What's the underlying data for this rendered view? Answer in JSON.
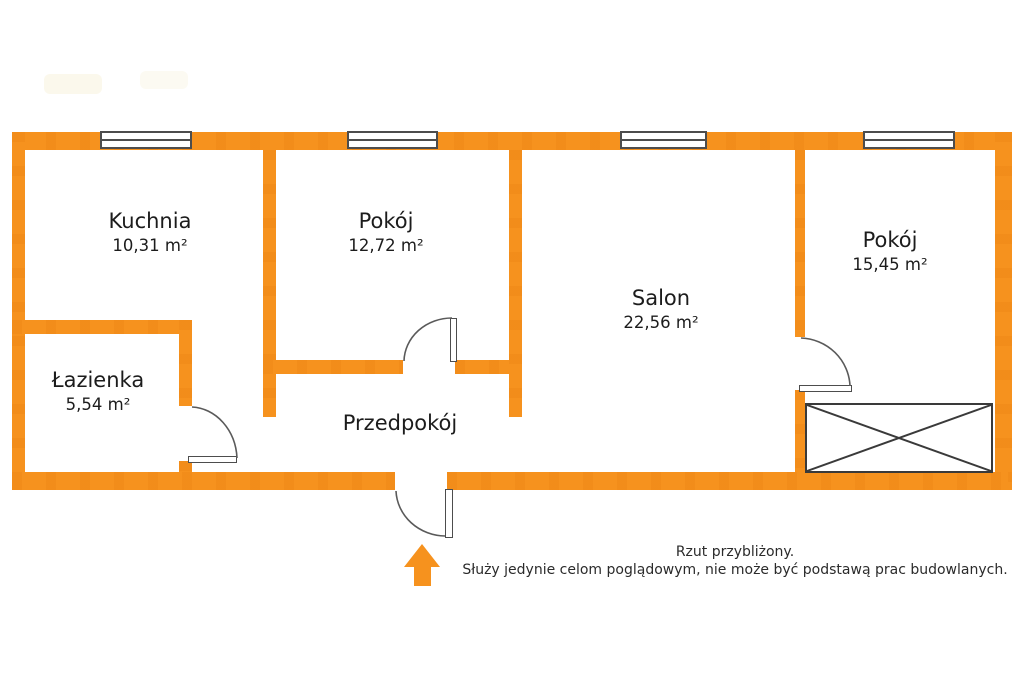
{
  "palette": {
    "wall_orange": "#f6921e",
    "outline_gray": "#4d4d4d",
    "text_color": "#1c1c1c"
  },
  "rooms": [
    {
      "id": "kuchnia",
      "name": "Kuchnia",
      "area": "10,31 m²"
    },
    {
      "id": "pokoj-1",
      "name": "Pokój",
      "area": "12,72 m²"
    },
    {
      "id": "salon",
      "name": "Salon",
      "area": "22,56 m²"
    },
    {
      "id": "pokoj-2",
      "name": "Pokój",
      "area": "15,45 m²"
    },
    {
      "id": "lazienka",
      "name": "Łazienka",
      "area": "5,54 m²"
    },
    {
      "id": "przedpokoj",
      "name": "Przedpokój",
      "area": ""
    }
  ],
  "disclaimer": {
    "line1": "Rzut przybliżony.",
    "line2": "Służy jedynie celom poglądowym, nie może być podstawą prac budowlanych."
  }
}
